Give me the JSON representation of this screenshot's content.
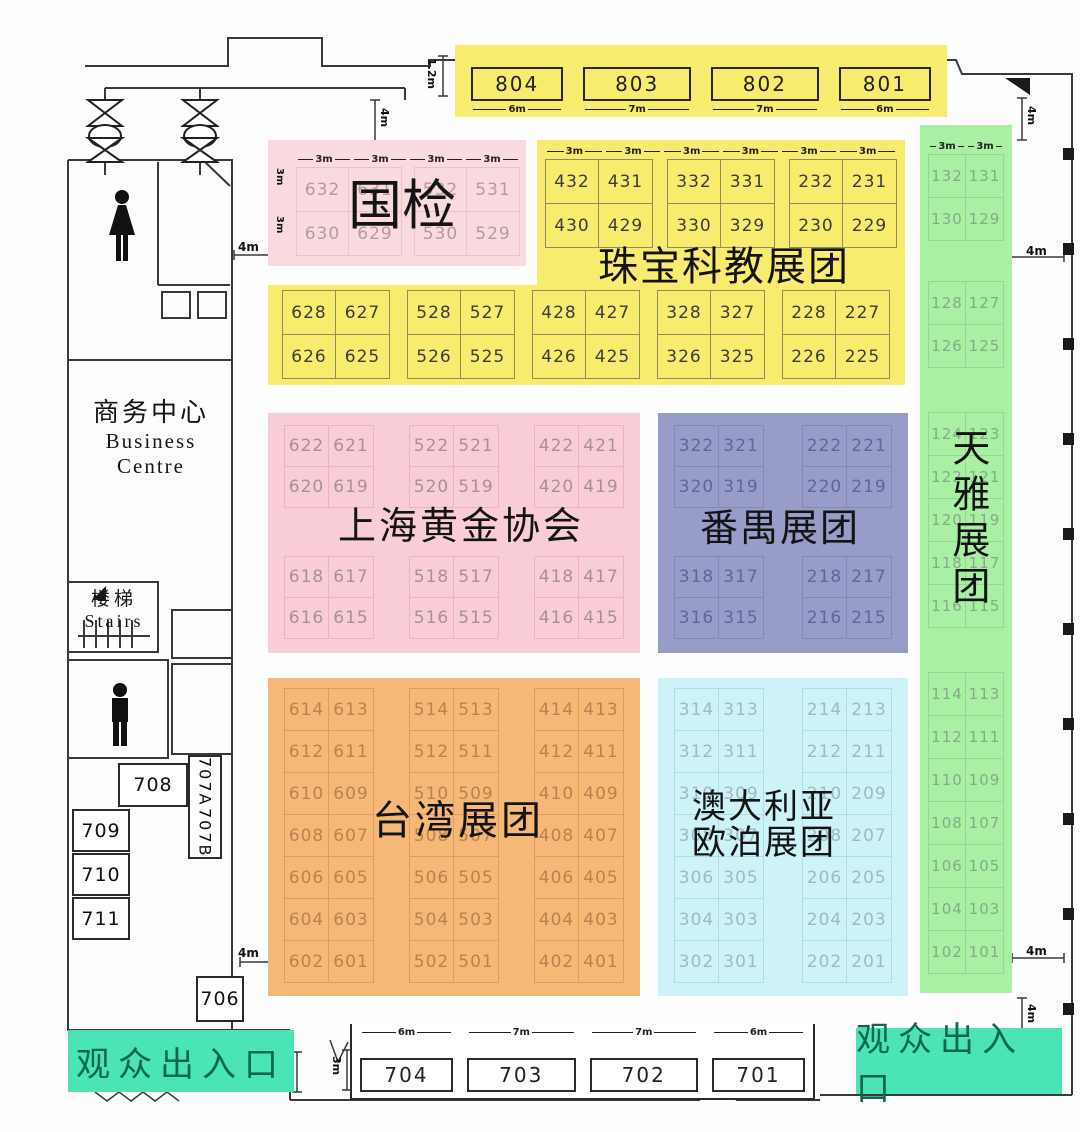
{
  "top_strip": {
    "height_dim": "1.2m",
    "booths": [
      {
        "id": "804",
        "dim": "6m"
      },
      {
        "id": "803",
        "dim": "7m"
      },
      {
        "id": "802",
        "dim": "7m"
      },
      {
        "id": "801",
        "dim": "6m"
      }
    ]
  },
  "guojian": {
    "label": "国检",
    "top_dims": [
      "3m",
      "3m",
      "3m",
      "3m"
    ],
    "side_dims": [
      "3m",
      "3m"
    ],
    "rows": [
      [
        [
          "632",
          "631"
        ],
        [
          "532",
          "531"
        ]
      ],
      [
        [
          "630",
          "629"
        ],
        [
          "530",
          "529"
        ]
      ]
    ]
  },
  "jewelry": {
    "label": "珠宝科教展团",
    "top_dims": [
      "3m",
      "3m",
      "3m",
      "3m",
      "3m",
      "3m"
    ],
    "upper_rows": [
      [
        [
          "432",
          "431"
        ],
        [
          "332",
          "331"
        ],
        [
          "232",
          "231"
        ]
      ],
      [
        [
          "430",
          "429"
        ],
        [
          "330",
          "329"
        ],
        [
          "230",
          "229"
        ]
      ]
    ],
    "lower_rows": [
      [
        [
          "628",
          "627"
        ],
        [
          "528",
          "527"
        ],
        [
          "428",
          "427"
        ],
        [
          "328",
          "327"
        ],
        [
          "228",
          "227"
        ]
      ],
      [
        [
          "626",
          "625"
        ],
        [
          "526",
          "525"
        ],
        [
          "426",
          "425"
        ],
        [
          "326",
          "325"
        ],
        [
          "226",
          "225"
        ]
      ]
    ]
  },
  "shanghai_gold": {
    "label": "上海黄金协会",
    "rows_top": [
      [
        [
          "622",
          "621"
        ],
        [
          "522",
          "521"
        ],
        [
          "422",
          "421"
        ]
      ],
      [
        [
          "620",
          "619"
        ],
        [
          "520",
          "519"
        ],
        [
          "420",
          "419"
        ]
      ]
    ],
    "rows_bottom": [
      [
        [
          "618",
          "617"
        ],
        [
          "518",
          "517"
        ],
        [
          "418",
          "417"
        ]
      ],
      [
        [
          "616",
          "615"
        ],
        [
          "516",
          "515"
        ],
        [
          "416",
          "415"
        ]
      ]
    ]
  },
  "panyu": {
    "label": "番禺展团",
    "rows_top": [
      [
        [
          "322",
          "321"
        ],
        [
          "222",
          "221"
        ]
      ],
      [
        [
          "320",
          "319"
        ],
        [
          "220",
          "219"
        ]
      ]
    ],
    "rows_bottom": [
      [
        [
          "318",
          "317"
        ],
        [
          "218",
          "217"
        ]
      ],
      [
        [
          "316",
          "315"
        ],
        [
          "216",
          "215"
        ]
      ]
    ]
  },
  "tianya": {
    "label": "天雅展团",
    "top_dims": [
      "3m",
      "3m"
    ],
    "group1": [
      [
        [
          "132",
          "131"
        ]
      ],
      [
        [
          "130",
          "129"
        ]
      ]
    ],
    "group2": [
      [
        [
          "128",
          "127"
        ]
      ],
      [
        [
          "126",
          "125"
        ]
      ]
    ],
    "group3": [
      [
        [
          "124",
          "123"
        ]
      ],
      [
        [
          "122",
          "121"
        ]
      ],
      [
        [
          "120",
          "119"
        ]
      ],
      [
        [
          "118",
          "117"
        ]
      ],
      [
        [
          "116",
          "115"
        ]
      ]
    ],
    "group4": [
      [
        [
          "114",
          "113"
        ]
      ],
      [
        [
          "112",
          "111"
        ]
      ],
      [
        [
          "110",
          "109"
        ]
      ],
      [
        [
          "108",
          "107"
        ]
      ],
      [
        [
          "106",
          "105"
        ]
      ],
      [
        [
          "104",
          "103"
        ]
      ],
      [
        [
          "102",
          "101"
        ]
      ]
    ]
  },
  "taiwan": {
    "label": "台湾展团",
    "rows": [
      [
        [
          "614",
          "613"
        ],
        [
          "514",
          "513"
        ],
        [
          "414",
          "413"
        ]
      ],
      [
        [
          "612",
          "611"
        ],
        [
          "512",
          "511"
        ],
        [
          "412",
          "411"
        ]
      ],
      [
        [
          "610",
          "609"
        ],
        [
          "510",
          "509"
        ],
        [
          "410",
          "409"
        ]
      ],
      [
        [
          "608",
          "607"
        ],
        [
          "508",
          "507"
        ],
        [
          "408",
          "407"
        ]
      ],
      [
        [
          "606",
          "605"
        ],
        [
          "506",
          "505"
        ],
        [
          "406",
          "405"
        ]
      ],
      [
        [
          "604",
          "603"
        ],
        [
          "504",
          "503"
        ],
        [
          "404",
          "403"
        ]
      ],
      [
        [
          "602",
          "601"
        ],
        [
          "502",
          "501"
        ],
        [
          "402",
          "401"
        ]
      ]
    ]
  },
  "australia": {
    "label_line1": "澳大利亚",
    "label_line2": "欧泊展团",
    "rows": [
      [
        [
          "314",
          "313"
        ],
        [
          "214",
          "213"
        ]
      ],
      [
        [
          "312",
          "311"
        ],
        [
          "212",
          "211"
        ]
      ],
      [
        [
          "310",
          "309"
        ],
        [
          "210",
          "209"
        ]
      ],
      [
        [
          "308",
          "307"
        ],
        [
          "208",
          "207"
        ]
      ],
      [
        [
          "306",
          "305"
        ],
        [
          "206",
          "205"
        ]
      ],
      [
        [
          "304",
          "303"
        ],
        [
          "204",
          "203"
        ]
      ],
      [
        [
          "302",
          "301"
        ],
        [
          "202",
          "201"
        ]
      ]
    ]
  },
  "bottom_strip": {
    "booths": [
      {
        "id": "704",
        "dim": "6m"
      },
      {
        "id": "703",
        "dim": "7m"
      },
      {
        "id": "702",
        "dim": "7m"
      },
      {
        "id": "701",
        "dim": "6m"
      }
    ],
    "side_dim_a": "2.5m",
    "side_dim_b": "3m"
  },
  "left_wing": {
    "business_centre_cn": "商务中心",
    "business_centre_en1": "Business",
    "business_centre_en2": "Centre",
    "stairs_cn": "楼梯",
    "stairs_en": "Stairs",
    "booth_708": "708",
    "booth_707a": "707A",
    "booth_707b": "707B",
    "booth_709": "709",
    "booth_710": "710",
    "booth_711": "711",
    "booth_706": "706"
  },
  "entrances": {
    "left": "观众出入口",
    "right": "观众出入口"
  },
  "dims": {
    "d4m": "4m",
    "d12m": "1.2m",
    "d3m": "3m",
    "d25m": "2.5m"
  },
  "colors": {
    "yellow": "#f7ec6e",
    "pink_light": "#f9dbdf",
    "pink": "#f8cdd6",
    "purple": "#979cc9",
    "green": "#a9efa4",
    "orange": "#f6b876",
    "lightblue": "#cdf2f8",
    "teal": "#4be4b7",
    "teal_text": "#0e6a4e"
  }
}
